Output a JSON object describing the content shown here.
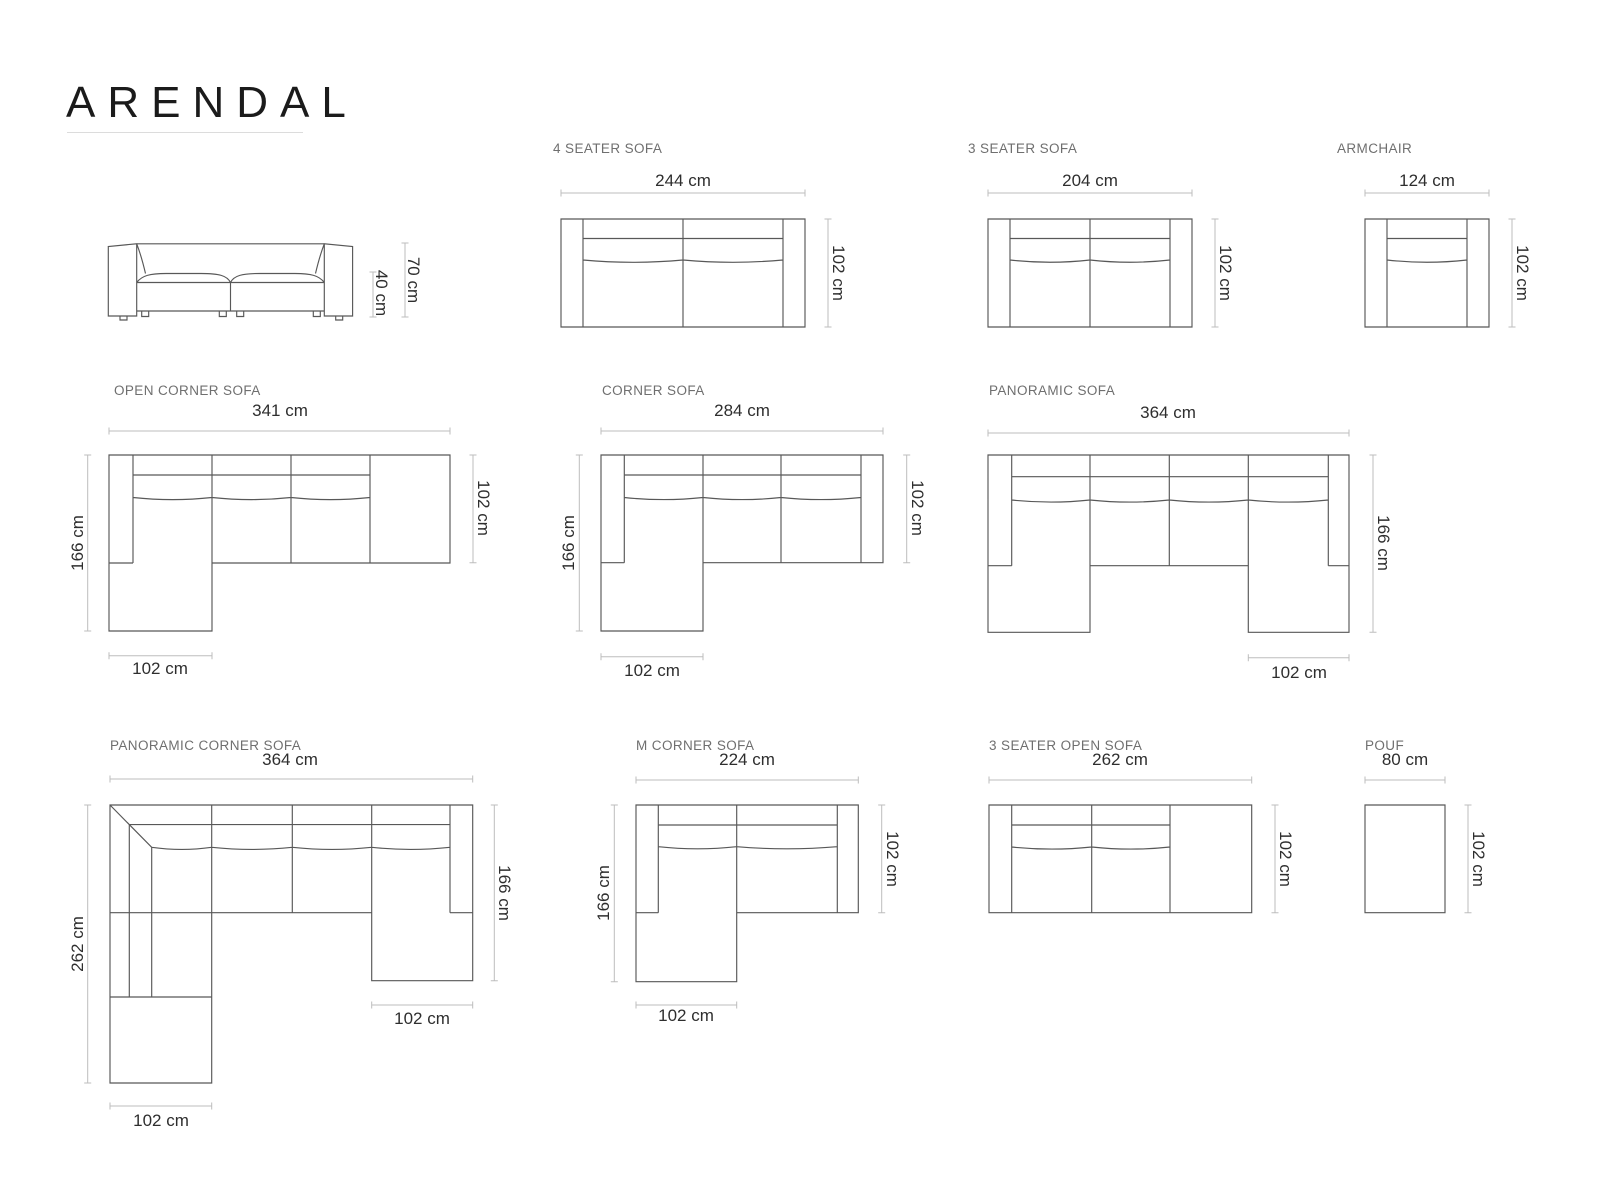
{
  "colors": {
    "title": "#1b1b1b",
    "section_label": "#6f6f6f",
    "dimension_text": "#2e2e2e",
    "sofa_line": "#585858",
    "dimension_line": "#bdbdbd",
    "background": "#ffffff"
  },
  "title": "ARENDAL",
  "diagrams": {
    "side_view": {
      "total_height": "70 cm",
      "seat_height": "40 cm"
    },
    "seater4": {
      "label": "4 SEATER SOFA",
      "width": "244 cm",
      "depth": "102 cm"
    },
    "seater3": {
      "label": "3 SEATER SOFA",
      "width": "204 cm",
      "depth": "102 cm"
    },
    "armchair": {
      "label": "ARMCHAIR",
      "width": "124 cm",
      "depth": "102 cm"
    },
    "open_corner": {
      "label": "OPEN CORNER SOFA",
      "width": "341 cm",
      "depth_total": "166 cm",
      "depth": "102 cm",
      "chaise_width": "102 cm"
    },
    "corner": {
      "label": "CORNER SOFA",
      "width": "284 cm",
      "depth_total": "166 cm",
      "depth": "102 cm",
      "chaise_width": "102 cm"
    },
    "panoramic": {
      "label": "PANORAMIC SOFA",
      "width": "364 cm",
      "depth_total": "166 cm",
      "chaise_width": "102 cm"
    },
    "panoramic_corner": {
      "label": "PANORAMIC CORNER SOFA",
      "width": "364 cm",
      "left_depth": "262 cm",
      "right_depth": "166 cm",
      "chaise_right_width": "102 cm",
      "chaise_bottom_width": "102 cm"
    },
    "m_corner": {
      "label": "M CORNER SOFA",
      "width": "224 cm",
      "left_depth": "166 cm",
      "right_depth": "102 cm",
      "chaise_width": "102 cm"
    },
    "open_3": {
      "label": "3 SEATER OPEN SOFA",
      "width": "262 cm",
      "depth": "102 cm"
    },
    "pouf": {
      "label": "POUF",
      "width": "80 cm",
      "depth": "102 cm"
    }
  }
}
